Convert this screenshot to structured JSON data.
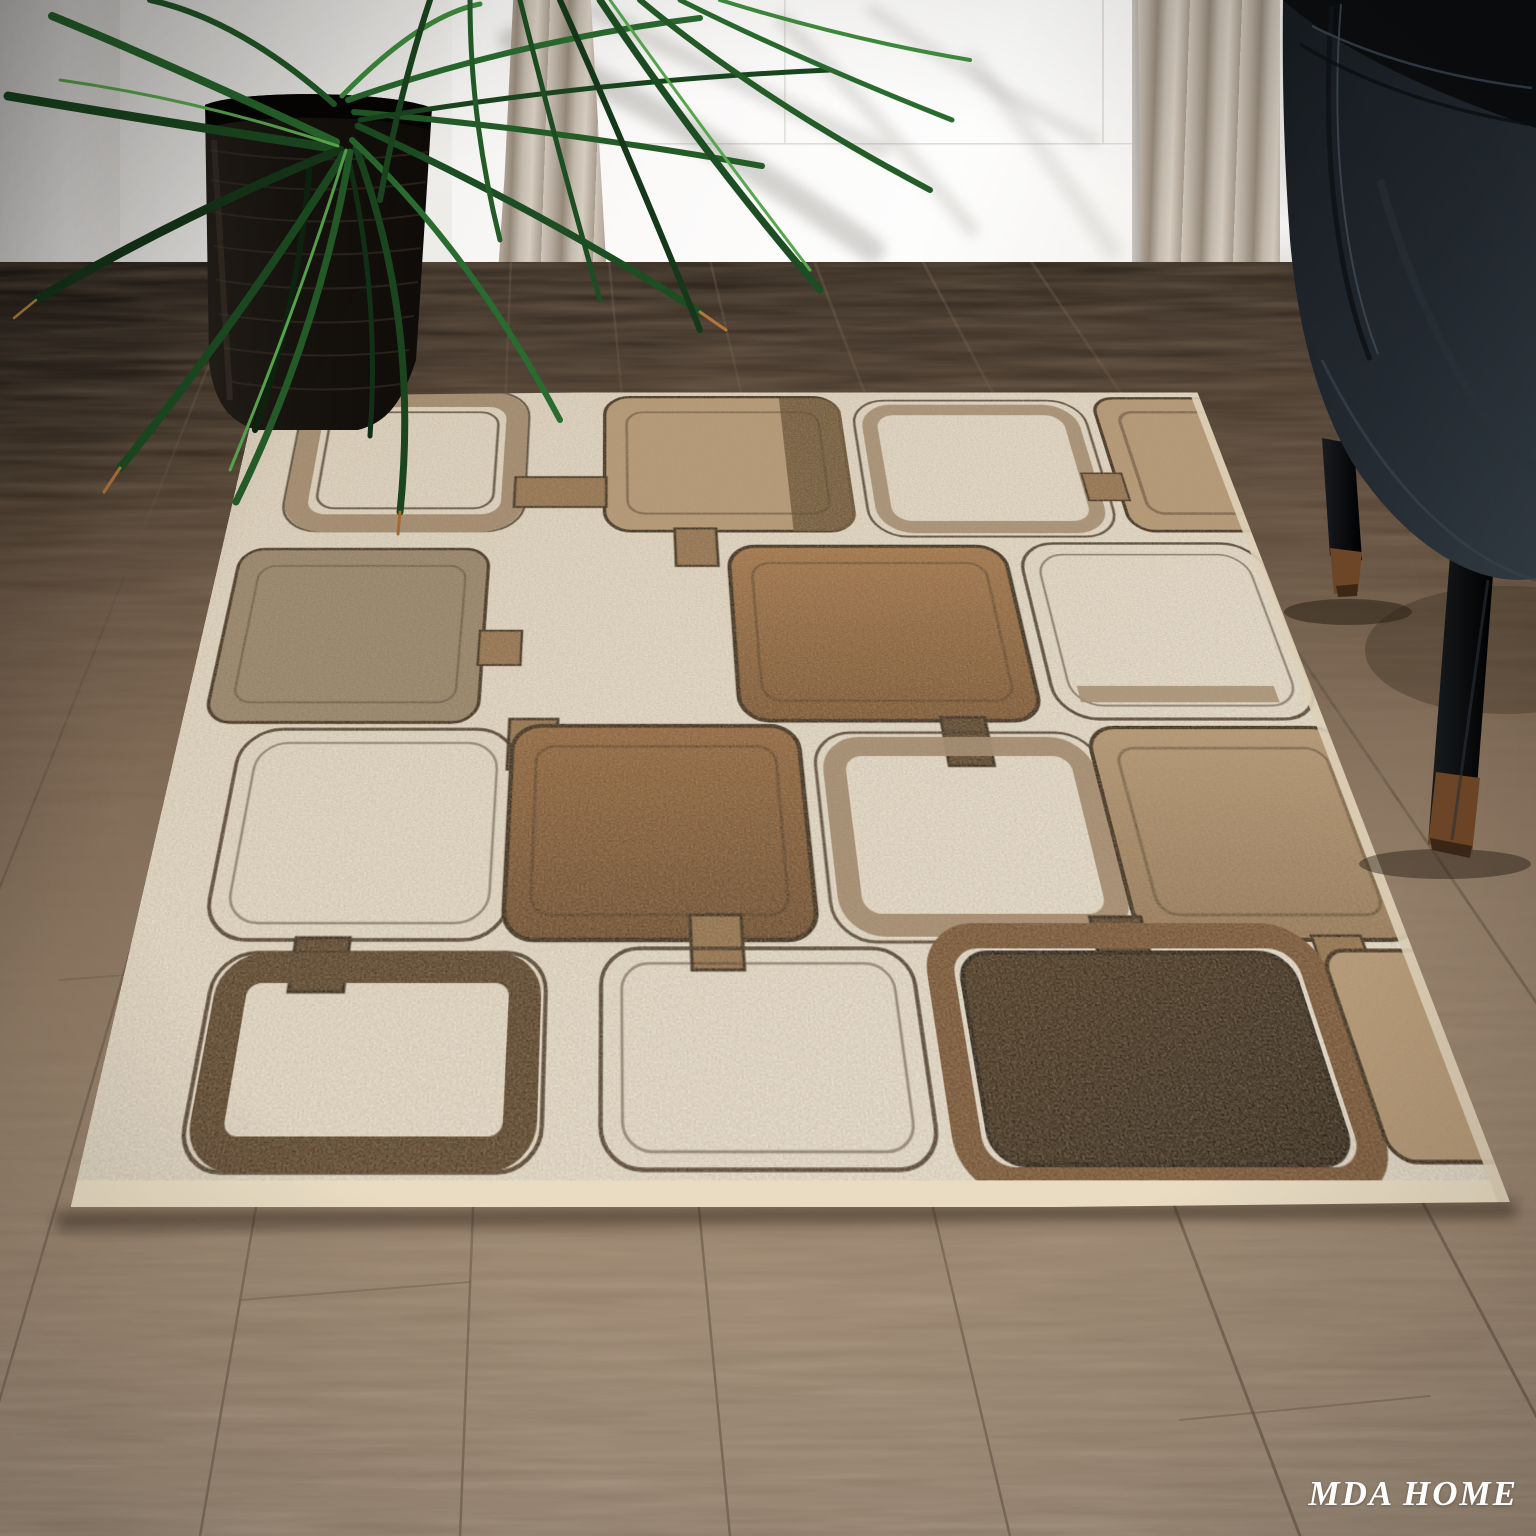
{
  "watermark": {
    "text": "MDA HOME",
    "color": "#ffffff"
  },
  "palette": {
    "wall": "#efedea",
    "door": "#fbfaf9",
    "door_groove": "#d9d5d0",
    "door_trim": "#f5f3f0",
    "baseboard": "#f8f7f5",
    "threshold": "#3c3128",
    "curtain_light": "#cfc5b9",
    "curtain_mid": "#b0a498",
    "curtain_dark": "#8f8376",
    "floor_dark": "#32281f",
    "floor_mid": "#7c6753",
    "floor_light": "#b2a08b",
    "floor_seam": "#594a3c",
    "floor_joint": "#6a5848",
    "leaf_darkest": "#0e2410",
    "leaf_dark": "#16381a",
    "leaf_mid": "#1d4d22",
    "leaf_green": "#2a6b2f",
    "leaf_bright": "#3f8c3f",
    "leaf_highlight": "#58a74f",
    "leaf_tip_brown": "#b5763a",
    "pot_body": "#17130f",
    "pot_rib": "#3c3328",
    "chair_body": "#222930",
    "chair_shadow": "#0b0d0f",
    "chair_seam": "#10151a",
    "chair_highlight": "#434e58",
    "chair_leg": "#0c0e10",
    "chair_leg_tip": "#6d4527",
    "rug_field_light": "#f0eadf",
    "rug_field": "#e7dfd0",
    "rug_binding": "#e9dcc3",
    "rug_contour": "#2b1d10",
    "rug_taupe_ring": "#9b8266",
    "rug_taupe_fill": "#8d7a62",
    "rug_tan": "#b2946f",
    "rug_tan_dark": "#5a4124",
    "rug_brown": "#8a5a30",
    "rug_brown_mid": "#9c6a3c",
    "rug_brown_deep": "#6f4724",
    "rug_link": "#8a6742",
    "rug_link_dark": "#46301b",
    "rug_chocolate": "#221609",
    "rug_chocolate_ring": "#6a4526"
  }
}
